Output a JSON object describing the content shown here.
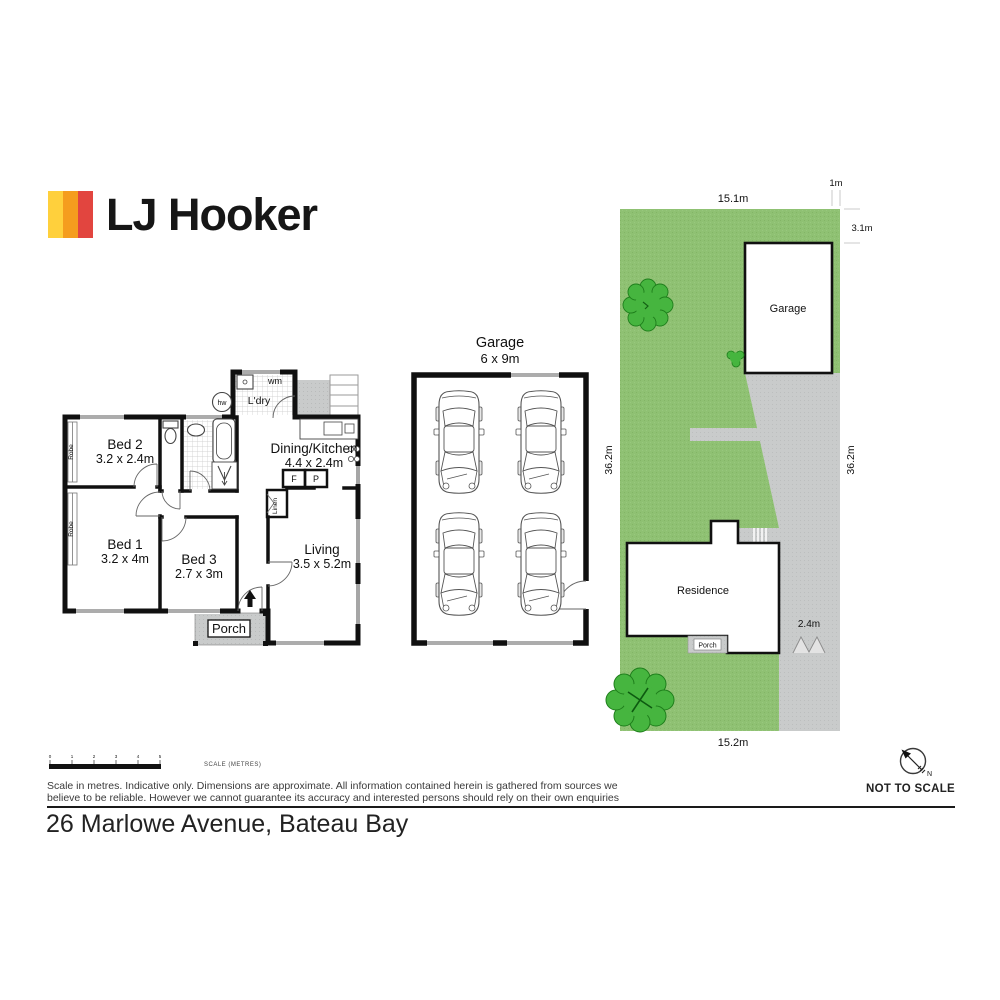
{
  "brand": {
    "name": "LJ Hooker",
    "stripes": [
      "#FFD03C",
      "#F59D1E",
      "#E2453F"
    ]
  },
  "floorplan": {
    "rooms": [
      {
        "name": "Bed 2",
        "dims": "3.2 x 2.4m"
      },
      {
        "name": "Bed 1",
        "dims": "3.2 x 4m"
      },
      {
        "name": "Bed 3",
        "dims": "2.7 x 3m"
      },
      {
        "name": "Dining/Kitchen",
        "dims": "4.4 x 2.4m"
      },
      {
        "name": "Living",
        "dims": "3.5 x 5.2m"
      }
    ],
    "labels": {
      "porch": "Porch",
      "laundry": "L'dry",
      "washing_machine": "wm",
      "hot_water": "hw",
      "linen": "Linen",
      "robe": "Robe",
      "fridge": "F",
      "pantry": "P"
    }
  },
  "garage_plan": {
    "title": "Garage",
    "dims": "6 x 9m"
  },
  "site_plan": {
    "garage": "Garage",
    "residence": "Residence",
    "porch": "Porch",
    "colors": {
      "lawn": "#8FC173",
      "driveway": "#C9CBCB",
      "tree": "#46B53F"
    },
    "dims": {
      "top": "15.1m",
      "bottom": "15.2m",
      "left": "36.2m",
      "right": "36.2m",
      "setback_right": "1m",
      "setback_top": "3.1m",
      "gate": "2.4m"
    }
  },
  "footer": {
    "scale_ticks": [
      "0",
      "1",
      "2",
      "3",
      "4",
      "5"
    ],
    "scale_caption": "SCALE (METRES)",
    "disclaimer1": "Scale in metres. Indicative only. Dimensions are approximate. All information contained herein is gathered from sources we",
    "disclaimer2": "believe to be reliable. However we cannot guarantee its accuracy and interested persons should rely on their own enquiries",
    "not_to_scale": "NOT TO SCALE",
    "compass_north": "N",
    "address": "26 Marlowe Avenue, Bateau Bay"
  }
}
